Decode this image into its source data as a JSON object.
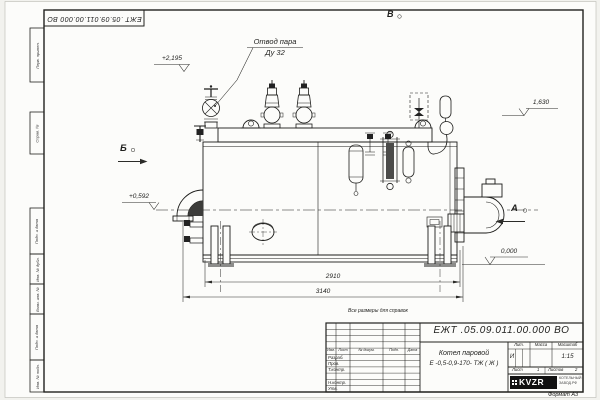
{
  "sheet": {
    "stamp_doc_number": "ЕЖТ .05.09.011.00.000  ВО",
    "format_note": "Формат А3",
    "reference_note": "Все размеры для справок"
  },
  "margin_columns": [
    "Перв. примен.",
    "Справ. №",
    "Подп. и дата",
    "Инв. № дубл.",
    "Взам. инв. №",
    "Подп. и дата",
    "Инв. № подл."
  ],
  "title_block": {
    "doc_number": "ЕЖТ .05.09.011.00.000  ВО",
    "product_line1": "Котел паровой",
    "product_line2": "Е -0,5-0,9-170- ТЖ ( Ж )",
    "col_izm": "Изм.",
    "col_list": "Лист",
    "col_doc": "№ докум.",
    "col_sign": "Подп.",
    "col_date": "Дата",
    "row_razrab": "Разраб.",
    "row_prov": "Пров.",
    "row_tkontr": "Т.контр.",
    "row_nkontr": "Н.контр.",
    "row_utv": "Утв.",
    "lit_header": "Лит.",
    "mass_header": "Масса",
    "scale_header": "Масштаб",
    "lit_value": "И",
    "scale_value": "1:15",
    "sheet_label": "Лист",
    "sheet_value": "1",
    "sheets_label": "Листов",
    "sheets_value": "2",
    "logo_text": "KVZR",
    "logo_caption1": "КОТЕЛЬНЫЙ",
    "logo_caption2": "ЗАВОД.РФ"
  },
  "annotations": {
    "steam_outlet_line1": "Отвод пара",
    "steam_outlet_line2": "Ду 32",
    "view_top": "В",
    "view_left": "Б",
    "view_right": "А",
    "elev_top": "+2,195",
    "elev_siphon": "1,630",
    "elev_axis": "+0,592",
    "elev_ground": "0,000",
    "dim_shell": "2910",
    "dim_overall": "3140"
  }
}
